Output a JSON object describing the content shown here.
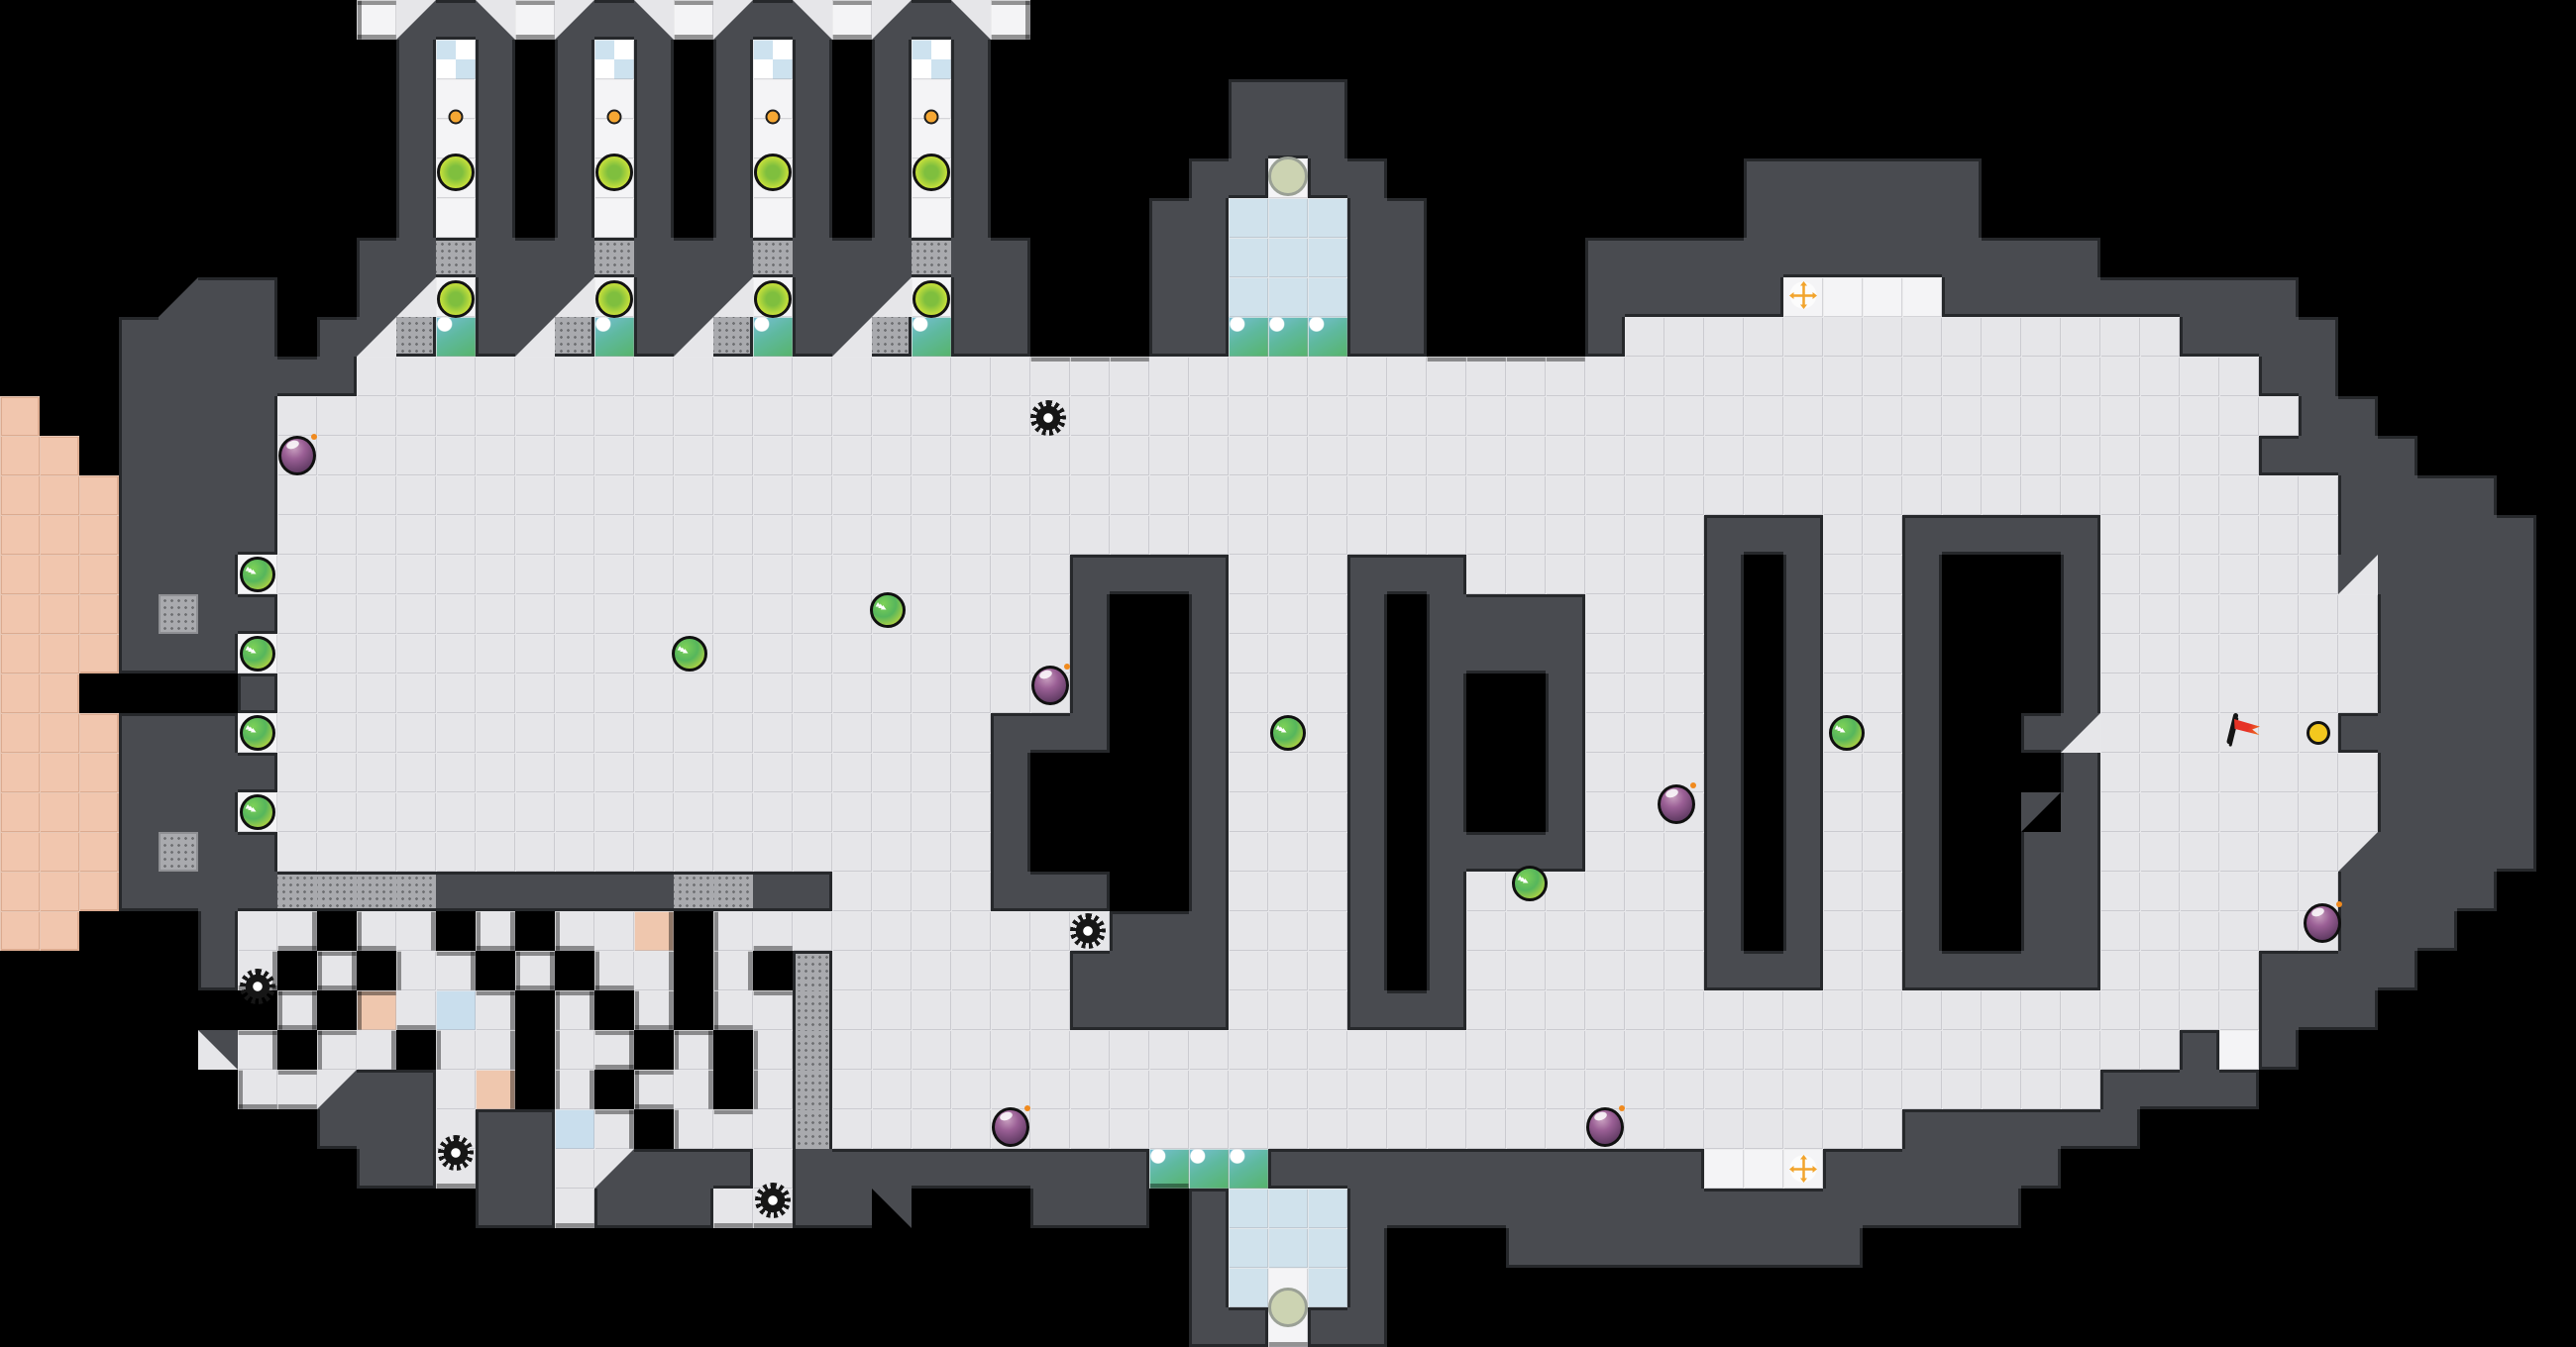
{
  "map": {
    "cols": 65,
    "rows": 34,
    "tile_size": 40,
    "legend": {
      ".": "floor-tile",
      "#": "hull-wall",
      "W": "white-tile",
      "g": "vent-grate",
      "C": "console-screen",
      "B": "pod-glass",
      "X": "checker-glass",
      "K": "pink-dock-tile",
      "p": "peach-tile",
      "u": "blue-tile",
      "1": "wall-diagonal-nw",
      "2": "wall-diagonal-se",
      "3": "wall-diagonal-ne",
      "4": "wall-diagonal-sw",
      " ": "space"
    },
    "tilemap": [
      "         W2#4W2#4W2#4W2#4W                                       ",
      "          #X# #X# #X# #X#                                        ",
      "          #W# #W# #W# #W#      ###                               ",
      "          #W# #W# #W# #W#      ###                               ",
      "          #W# #W# #W# #W#     ##W##         ######               ",
      "          #W# #W# #W# #W#    ##BBB##        ######               ",
      "         ##g###g###g###g##   ##BBB##    #############            ",
      "    2##  #1W##1W##1W##1W##   ##BBB##    #####WWWW#########       ",
      "   #### #1gC#1gC#1gC#1gC##   ##CCC##    #..............####      ",
      "   ######................................................##      ",
      "K  ####...................................................##     ",
      "KK ####..................................................####    ",
      "KKK####....................................................####  ",
      "KKK####....................................###..#####......##### ",
      "KKK###W....................####...###......# #..#   #......1#### ",
      "KKK#g##....................#  #...# ####...# #..#   #.......#### ",
      "KKK###W....................#  #...# ####...# #..#   #.......#### ",
      "KK    #....................#  #...# #  #...# #..#   #.......#### ",
      "KKK###W..................###  #...# #  #...# #..#  #1......##### ",
      "KKK####..................#    #...# #  #...# #..#   #.......#### ",
      "KKK###W..................#    #...# #  #...# #..#  1#.......#### ",
      "KKK#g##..................#    #...# ####...# #..#  ##......2#### ",
      "KKK####gggg######gg##....###  #...# #......# #..#  ##......####  ",
      "KK   #.. .. . ..p ..........###...# #......# #..#  ##......###   ",
      "     #. . .. . .. . g......####...# #......###..#####....####    ",
      "       . p.u. . . ..g......####...###....................###     ",
      "     3. .. .. .. . .g..................................#W#      ",
      "      ..2##.p . .. .g................................####       ",
      "        ###.##u. ...g...........................######           ",
      "         ##.##.2###.#########CCC###########WWW######           ",
      "            ##.###..##3   ### #BBB#################              ",
      "                              #BBB#   #########                  ",
      "                              #BWB#                              ",
      "                              ##W##                              "
    ]
  },
  "colors": {
    "space": "#000000",
    "wall": "#494b50",
    "wall_outline": "#26282b",
    "floor": "#e6e6e9",
    "floor_line": "#d2d2d6",
    "pink": "#f1c6ae",
    "pink_line": "#dcab90",
    "hull_edge_shadow": "rgba(0,0,0,0.4)",
    "orb_green": "#56b65c",
    "bomb_purple": "#5f3a62",
    "flag_red": "#e63226",
    "cross_orange": "#f2a42c",
    "pod_circle_green": "#cfe43a",
    "console_teal": "#5fb9a0"
  },
  "items": [
    {
      "type": "orb",
      "name": "chevron-orb",
      "glyph": "▸▸▸",
      "x": 6.5,
      "y": 14.5,
      "interactable": true
    },
    {
      "type": "orb",
      "name": "chevron-orb",
      "glyph": "▸▸▸",
      "x": 6.5,
      "y": 16.5,
      "interactable": true
    },
    {
      "type": "orb",
      "name": "chevron-orb",
      "glyph": "▸▸▸",
      "x": 6.5,
      "y": 18.5,
      "interactable": true
    },
    {
      "type": "orb",
      "name": "chevron-orb",
      "glyph": "▸▸▸",
      "x": 6.5,
      "y": 20.5,
      "interactable": true
    },
    {
      "type": "orb",
      "name": "chevron-orb",
      "glyph": "▸▸▸",
      "x": 17.4,
      "y": 16.5,
      "interactable": true
    },
    {
      "type": "orb",
      "name": "chevron-orb",
      "glyph": "▸▸▸",
      "x": 22.4,
      "y": 15.4,
      "interactable": true
    },
    {
      "type": "orb",
      "name": "chevron-orb",
      "glyph": "▸▸▸",
      "x": 32.5,
      "y": 18.5,
      "interactable": true
    },
    {
      "type": "orb",
      "name": "chevron-orb",
      "glyph": "▸▸▸",
      "x": 38.6,
      "y": 22.3,
      "interactable": true
    },
    {
      "type": "orb",
      "name": "chevron-orb",
      "glyph": "▸▸▸",
      "x": 46.6,
      "y": 18.5,
      "interactable": true
    },
    {
      "type": "bomb",
      "name": "bomb-item",
      "x": 7.5,
      "y": 11.5,
      "interactable": true
    },
    {
      "type": "bomb",
      "name": "bomb-item",
      "x": 26.5,
      "y": 17.3,
      "interactable": true
    },
    {
      "type": "bomb",
      "name": "bomb-item",
      "x": 25.5,
      "y": 28.45,
      "interactable": true
    },
    {
      "type": "bomb",
      "name": "bomb-item",
      "x": 40.5,
      "y": 28.45,
      "interactable": true
    },
    {
      "type": "bomb",
      "name": "bomb-item",
      "x": 42.3,
      "y": 20.3,
      "interactable": true
    },
    {
      "type": "bomb",
      "name": "bomb-item",
      "x": 58.6,
      "y": 23.3,
      "interactable": true
    },
    {
      "type": "gear",
      "name": "gear-item",
      "x": 26.45,
      "y": 10.55,
      "interactable": true
    },
    {
      "type": "gear",
      "name": "gear-item",
      "x": 27.45,
      "y": 23.5,
      "interactable": true
    },
    {
      "type": "gear",
      "name": "gear-item",
      "x": 6.5,
      "y": 24.9,
      "interactable": true
    },
    {
      "type": "gear",
      "name": "gear-item",
      "x": 11.5,
      "y": 29.1,
      "interactable": true
    },
    {
      "type": "gear",
      "name": "gear-item",
      "x": 19.5,
      "y": 30.3,
      "interactable": true
    },
    {
      "type": "big-circle",
      "name": "pod-occupant-circle",
      "x": 11.5,
      "y": 4.35,
      "interactable": false
    },
    {
      "type": "big-circle",
      "name": "pod-occupant-circle",
      "x": 15.5,
      "y": 4.35,
      "interactable": false
    },
    {
      "type": "big-circle",
      "name": "pod-occupant-circle",
      "x": 19.5,
      "y": 4.35,
      "interactable": false
    },
    {
      "type": "big-circle",
      "name": "pod-occupant-circle",
      "x": 23.5,
      "y": 4.35,
      "interactable": false
    },
    {
      "type": "big-circle",
      "name": "bay-occupant-circle",
      "x": 11.5,
      "y": 7.55,
      "interactable": false
    },
    {
      "type": "big-circle",
      "name": "bay-occupant-circle",
      "x": 15.5,
      "y": 7.55,
      "interactable": false
    },
    {
      "type": "big-circle",
      "name": "bay-occupant-circle",
      "x": 19.5,
      "y": 7.55,
      "interactable": false
    },
    {
      "type": "big-circle",
      "name": "bay-occupant-circle",
      "x": 23.5,
      "y": 7.55,
      "interactable": false
    },
    {
      "type": "small-dot",
      "name": "pod-button-dot",
      "x": 11.5,
      "y": 2.95,
      "interactable": false
    },
    {
      "type": "small-dot",
      "name": "pod-button-dot",
      "x": 15.5,
      "y": 2.95,
      "interactable": false
    },
    {
      "type": "small-dot",
      "name": "pod-button-dot",
      "x": 19.5,
      "y": 2.95,
      "interactable": false
    },
    {
      "type": "small-dot",
      "name": "pod-button-dot",
      "x": 23.5,
      "y": 2.95,
      "interactable": false
    },
    {
      "type": "pale-circle",
      "name": "airlock-pad-circle",
      "x": 32.5,
      "y": 4.45,
      "interactable": false
    },
    {
      "type": "pale-circle",
      "name": "airlock-pad-circle",
      "x": 32.5,
      "y": 33.0,
      "interactable": false
    },
    {
      "type": "cross",
      "name": "move-marker-cross",
      "x": 45.5,
      "y": 7.45,
      "interactable": false
    },
    {
      "type": "cross",
      "name": "move-marker-cross",
      "x": 45.5,
      "y": 29.5,
      "interactable": false
    },
    {
      "type": "flag",
      "name": "goal-flag",
      "x": 56.6,
      "y": 18.5,
      "interactable": true
    },
    {
      "type": "yellow-dot",
      "name": "yellow-dot-item",
      "x": 58.5,
      "y": 18.5,
      "interactable": true
    }
  ]
}
